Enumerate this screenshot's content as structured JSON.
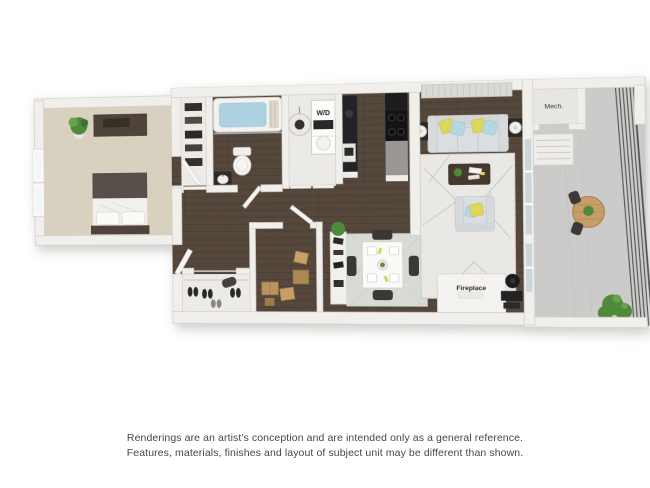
{
  "floorplan": {
    "labels": {
      "washer_dryer": "W/D",
      "mech": "Mech.",
      "fireplace": "Fireplace"
    },
    "colors": {
      "background": "#ffffff",
      "wall": "#f1efec",
      "wall_edge": "#d3cfca",
      "wood_floor": "#55473b",
      "wood_line": "#483c31",
      "carpet": "#d9d1c0",
      "closet_floor": "#edebe7",
      "balcony_floor": "#cbcbc9",
      "railing": "#4f4f4f",
      "sofa": "#dbdee0",
      "pillow_yellow": "#ddd75a",
      "pillow_blue": "#b7d7e0",
      "rug": "#eae8e4",
      "rug_line": "#cdcac4",
      "dining_rug": "#d8dad4",
      "dark_furniture": "#262629",
      "brown_furniture": "#4e433a",
      "coffee_table": "#463a2e",
      "box_cardboard": "#bb9360",
      "plant_green": "#4e8a3a",
      "tub_water": "#aed2e2",
      "glass": "#ccd5d7",
      "label_text": "#222222"
    }
  },
  "disclaimer": {
    "line1": "Renderings are an artist's conception and are intended only as a general reference.",
    "line2": "Features, materials, finishes and layout of subject unit may be different than shown."
  }
}
